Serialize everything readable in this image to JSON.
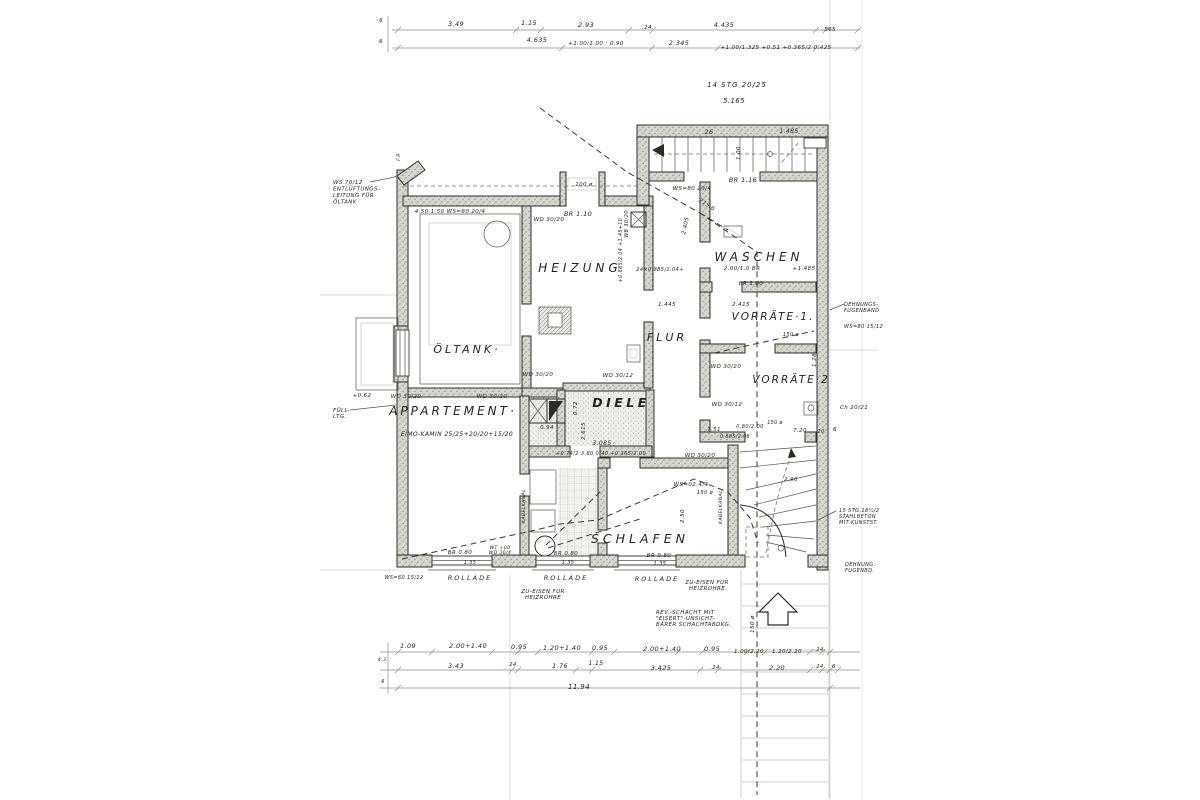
{
  "document_kind": "hand-drawn architectural floor plan (basement / Kellergeschoss), German annotations",
  "colors": {
    "paper": "#ffffff",
    "ink": "#2c2c26",
    "wall_fill": "#d7d7d0",
    "faint": "#c6c6bd"
  },
  "rooms": [
    "HEIZUNG",
    "WASCHEN",
    "VORRÄTE·1.",
    "VORRÄTE·2",
    "FLUR",
    "DIELE",
    "ÖLTANK·",
    "APPARTEMENT·",
    "SCHLAFEN"
  ],
  "annotations": [
    {
      "n": "room-label-heizung",
      "t": "HEIZUNG",
      "x": 580,
      "y": 272,
      "s": 12,
      "ls": 4
    },
    {
      "n": "room-label-waschen",
      "t": "WASCHEN",
      "x": 759,
      "y": 261,
      "s": 12,
      "ls": 4
    },
    {
      "n": "room-label-vorraete-1",
      "t": "VORRÄTE·1.",
      "x": 773,
      "y": 320,
      "s": 10.5,
      "ls": 2
    },
    {
      "n": "room-label-vorraete-2",
      "t": "VORRÄTE·2",
      "x": 791,
      "y": 383,
      "s": 10.5,
      "ls": 2
    },
    {
      "n": "room-label-flur",
      "t": "FLUR",
      "x": 667,
      "y": 341,
      "s": 11,
      "ls": 3
    },
    {
      "n": "room-label-diele",
      "t": "DIELE",
      "x": 621,
      "y": 407,
      "s": 12.5,
      "ls": 3.5,
      "w": "bold"
    },
    {
      "n": "room-label-oeltank",
      "t": "ÖLTANK·",
      "x": 467,
      "y": 353,
      "s": 11,
      "ls": 3
    },
    {
      "n": "room-label-appartement",
      "t": "APPARTEMENT·",
      "x": 453,
      "y": 415,
      "s": 12,
      "ls": 3
    },
    {
      "n": "room-label-schlafen",
      "t": "SCHLAFEN",
      "x": 640,
      "y": 543,
      "s": 12.5,
      "ls": 4
    },
    {
      "n": "note-rollade-1",
      "t": "ROLLADE",
      "x": 470,
      "y": 580,
      "s": 6.5,
      "ls": 2
    },
    {
      "n": "note-rollade-2",
      "t": "ROLLADE",
      "x": 566,
      "y": 580,
      "s": 6.5,
      "ls": 2
    },
    {
      "n": "note-rollade-3",
      "t": "ROLLADE",
      "x": 657,
      "y": 581,
      "s": 6.5,
      "ls": 2
    },
    {
      "n": "note-zueisen-1",
      "L": [
        "ZU-EISEN FUR",
        "HEIZROHRE"
      ],
      "x": 543,
      "y": 593,
      "s": 5.5,
      "lh": 6
    },
    {
      "n": "note-zueisen-2",
      "L": [
        "ZU-EISEN FUR",
        "HEIZROHRE"
      ],
      "x": 707,
      "y": 584,
      "s": 5.5,
      "lh": 6
    },
    {
      "n": "note-rev-schacht",
      "L": [
        "REV.-SCHACHT MIT",
        "\"EISERT\"-UNSICHT-",
        "BARER SCHACHTABDKG."
      ],
      "x": 656,
      "y": 614,
      "s": 5.5,
      "lh": 6,
      "a": "start"
    },
    {
      "n": "note-entlueftung",
      "L": [
        "WS 70/12",
        "ENTLÜFTUNGS-",
        "LEITUNG FÜR",
        "ÖLTANK"
      ],
      "x": 333,
      "y": 184,
      "s": 5.5,
      "lh": 6.5,
      "a": "start"
    },
    {
      "n": "note-fuell-ltg",
      "L": [
        "FÜLL-",
        "LTG."
      ],
      "x": 333,
      "y": 412,
      "s": 5.5,
      "lh": 6,
      "a": "start"
    },
    {
      "t": "+0.62",
      "x": 362,
      "y": 397,
      "s": 5.5
    },
    {
      "n": "note-stair-top",
      "t": "14 STG 20/25",
      "x": 737,
      "y": 87,
      "s": 7,
      "ls": 1
    },
    {
      "t": "5.165",
      "x": 734,
      "y": 103,
      "s": 7
    },
    {
      "t": "BR 1.16",
      "x": 743,
      "y": 182,
      "s": 6.5
    },
    {
      "t": "26",
      "x": 709,
      "y": 134,
      "s": 6.5
    },
    {
      "t": "1.485",
      "x": 789,
      "y": 133,
      "s": 6
    },
    {
      "t": "1.00",
      "x": 740,
      "y": 153,
      "s": 5.5,
      "r": -90
    },
    {
      "t": "WS=80 20/4",
      "x": 692,
      "y": 190,
      "s": 5.5
    },
    {
      "t": "215.6",
      "x": 706,
      "y": 206,
      "s": 5.5,
      "r": 33
    },
    {
      "t": "4.50·1.50  WS=80 20/4",
      "x": 450,
      "y": 213,
      "s": 5.5
    },
    {
      "t": "BR 1.10",
      "x": 578,
      "y": 216,
      "s": 6.5
    },
    {
      "t": "100 ø",
      "x": 584,
      "y": 186,
      "s": 5.5
    },
    {
      "t": "F.R",
      "x": 400,
      "y": 157,
      "s": 4.5,
      "r": -90
    },
    {
      "t": "WD 30/20",
      "x": 549,
      "y": 221,
      "s": 5.5
    },
    {
      "t": "WD 30/20",
      "x": 538,
      "y": 376,
      "s": 5.5
    },
    {
      "t": "WD 30/12",
      "x": 618,
      "y": 377,
      "s": 5.5
    },
    {
      "t": "WD 30/20",
      "x": 726,
      "y": 368,
      "s": 5.5
    },
    {
      "t": "WD 30/12",
      "x": 727,
      "y": 406,
      "s": 5.5
    },
    {
      "t": "WD 30/20",
      "x": 406,
      "y": 398,
      "s": 5.5
    },
    {
      "t": "WD 30/20",
      "x": 492,
      "y": 398,
      "s": 5.5
    },
    {
      "t": "WD 30/20",
      "x": 700,
      "y": 457,
      "s": 5.5
    },
    {
      "t": "WB 30/20",
      "x": 628,
      "y": 224,
      "s": 5,
      "r": -90
    },
    {
      "n": "note-kamin",
      "t": "EIMO-KAMIN 25/25+20/20+15/20",
      "x": 457,
      "y": 436,
      "s": 6
    },
    {
      "t": "2.00/1.0 BR",
      "x": 742,
      "y": 270,
      "s": 5.5
    },
    {
      "t": "BR 1.00",
      "x": 751,
      "y": 285,
      "s": 5.5
    },
    {
      "t": "+1.485",
      "x": 804,
      "y": 270,
      "s": 5.5
    },
    {
      "t": "1.445",
      "x": 667,
      "y": 306,
      "s": 5.5
    },
    {
      "t": "2.415",
      "x": 741,
      "y": 306,
      "s": 5.5
    },
    {
      "t": "24×0.885/2.04+",
      "x": 660,
      "y": 271,
      "s": 5
    },
    {
      "t": "+0.885/2.04 +1.45+10",
      "x": 622,
      "y": 250,
      "s": 4.8,
      "r": -90
    },
    {
      "t": "2.405",
      "x": 687,
      "y": 226,
      "s": 5.5,
      "r": -78
    },
    {
      "n": "note-dehnungsfuge",
      "L": [
        "DEHNUNGS-",
        "FUGENBAND"
      ],
      "x": 844,
      "y": 306,
      "s": 5,
      "lh": 6,
      "a": "start"
    },
    {
      "t": "WS=80 15/12",
      "x": 844,
      "y": 328,
      "s": 5,
      "a": "start"
    },
    {
      "t": "Ch 20/21",
      "x": 840,
      "y": 409,
      "s": 5.5,
      "a": "start"
    },
    {
      "t": "1.28",
      "x": 816,
      "y": 360,
      "s": 5.5,
      "r": -90
    },
    {
      "t": "150 ø",
      "x": 791,
      "y": 336,
      "s": 5
    },
    {
      "n": "note-stair-right",
      "L": [
        "15 STG.18½/2",
        "STAHLBETON",
        "MIT KUNSTST."
      ],
      "x": 839,
      "y": 512,
      "s": 5,
      "lh": 6,
      "a": "start"
    },
    {
      "L": [
        "DEHNUNG.",
        "FUGENBD."
      ],
      "x": 845,
      "y": 566,
      "s": 5,
      "lh": 6,
      "a": "start"
    },
    {
      "t": "3.085",
      "x": 602,
      "y": 445,
      "s": 6
    },
    {
      "t": "+0.74/2 3.80 0.40 +0.365/2.00",
      "x": 601,
      "y": 455,
      "s": 5
    },
    {
      "t": "0.94",
      "x": 547,
      "y": 429,
      "s": 5.5
    },
    {
      "t": "0.72",
      "x": 577,
      "y": 408,
      "s": 5.5,
      "r": -90
    },
    {
      "t": "2.615",
      "x": 585,
      "y": 431,
      "s": 5.5,
      "r": -90
    },
    {
      "t": "1.35",
      "x": 470,
      "y": 564,
      "s": 5
    },
    {
      "t": "1.35",
      "x": 568,
      "y": 564,
      "s": 5
    },
    {
      "t": "1.35",
      "x": 660,
      "y": 565,
      "s": 5
    },
    {
      "t": "BR 0.80",
      "x": 460,
      "y": 554,
      "s": 5.5
    },
    {
      "t": "BR 0.80",
      "x": 566,
      "y": 555,
      "s": 5.5
    },
    {
      "t": "BR 0.80",
      "x": 659,
      "y": 557,
      "s": 5.5
    },
    {
      "L": [
        "WT +00",
        "WD 30/4"
      ],
      "x": 500,
      "y": 549,
      "s": 4.6,
      "lh": 5
    },
    {
      "t": "WS=60 15/12",
      "x": 404,
      "y": 579,
      "s": 5
    },
    {
      "t": "WS=02.4/4",
      "x": 691,
      "y": 486,
      "s": 5.5
    },
    {
      "t": "150 ø",
      "x": 705,
      "y": 494,
      "s": 5
    },
    {
      "t": "2.50",
      "x": 684,
      "y": 516,
      "s": 5.5,
      "r": -90
    },
    {
      "t": "KABELKANAL",
      "x": 722,
      "y": 507,
      "s": 4.6,
      "r": -90
    },
    {
      "t": "KABELKANAL",
      "x": 525,
      "y": 506,
      "s": 4.6,
      "r": -90
    },
    {
      "t": "7.51",
      "x": 714,
      "y": 431,
      "s": 5.5
    },
    {
      "t": "0.80/2.00",
      "x": 750,
      "y": 428,
      "s": 5
    },
    {
      "t": "2.90",
      "x": 791,
      "y": 481,
      "s": 5.5
    },
    {
      "t": "7.20",
      "x": 800,
      "y": 432,
      "s": 5.5
    },
    {
      "t": "150 ø",
      "x": 775,
      "y": 424,
      "s": 4.8
    },
    {
      "t": "0.885/2.08",
      "x": 735,
      "y": 438,
      "s": 4.8
    },
    {
      "t": ".20.",
      "x": 821,
      "y": 433,
      "s": 4.8
    },
    {
      "t": "6",
      "x": 835,
      "y": 431,
      "s": 5.5
    },
    {
      "t": "150 ø",
      "x": 754,
      "y": 624,
      "s": 5.5,
      "r": -90
    },
    {
      "t": "3.49",
      "x": 456,
      "y": 26,
      "s": 6.5
    },
    {
      "t": "1.15",
      "x": 529,
      "y": 25,
      "s": 6.5
    },
    {
      "t": "2.93",
      "x": 586,
      "y": 27,
      "s": 6.5
    },
    {
      "t": ".24.",
      "x": 648,
      "y": 29,
      "s": 5.5
    },
    {
      "t": "4.435",
      "x": 724,
      "y": 27,
      "s": 6.5
    },
    {
      "t": ".565",
      "x": 829,
      "y": 31,
      "s": 5.5
    },
    {
      "t": "4.635",
      "x": 537,
      "y": 42,
      "s": 6.5
    },
    {
      "t": "+1.00/1.00 : 0.90",
      "x": 596,
      "y": 45,
      "s": 5.5
    },
    {
      "t": "2.345",
      "x": 679,
      "y": 45,
      "s": 6.5
    },
    {
      "t": "+1.00/1.325 +0.51 +0.365/2 0.425",
      "x": 776,
      "y": 49,
      "s": 5.5
    },
    {
      "t": "6",
      "x": 381,
      "y": 22,
      "s": 5
    },
    {
      "t": "6",
      "x": 381,
      "y": 43,
      "s": 5
    },
    {
      "t": "1.09",
      "x": 408,
      "y": 648,
      "s": 6.5
    },
    {
      "t": "2.00+1.40",
      "x": 468,
      "y": 648,
      "s": 6.5
    },
    {
      "t": "0.95",
      "x": 519,
      "y": 649,
      "s": 6.5
    },
    {
      "t": "1.20+1.40",
      "x": 562,
      "y": 650,
      "s": 6.5
    },
    {
      "t": "0.95",
      "x": 600,
      "y": 650,
      "s": 6.5
    },
    {
      "t": "2.00+1.40",
      "x": 662,
      "y": 651,
      "s": 6.5
    },
    {
      "t": "0.95",
      "x": 712,
      "y": 651,
      "s": 6.5
    },
    {
      "t": "1.00/2.20",
      "x": 749,
      "y": 653,
      "s": 5.5
    },
    {
      "t": "1.20/2.20",
      "x": 787,
      "y": 653,
      "s": 5.5
    },
    {
      "t": ".24.",
      "x": 820,
      "y": 651,
      "s": 5
    },
    {
      "t": "3.43",
      "x": 456,
      "y": 668,
      "s": 6.5
    },
    {
      "t": ".24.",
      "x": 513,
      "y": 666,
      "s": 5
    },
    {
      "t": "1.76",
      "x": 560,
      "y": 668,
      "s": 6.5
    },
    {
      "t": "1.15",
      "x": 596,
      "y": 665,
      "s": 6
    },
    {
      "t": "3.425",
      "x": 661,
      "y": 670,
      "s": 6.5
    },
    {
      "t": ".24.",
      "x": 716,
      "y": 669,
      "s": 5
    },
    {
      "t": "2.20",
      "x": 777,
      "y": 670,
      "s": 6.5
    },
    {
      "t": ".24.",
      "x": 820,
      "y": 668,
      "s": 5
    },
    {
      "t": "6",
      "x": 834,
      "y": 668,
      "s": 5.5
    },
    {
      "t": "11.94",
      "x": 579,
      "y": 689,
      "s": 7
    },
    {
      "t": "4.3.",
      "x": 383,
      "y": 661,
      "s": 4.5
    },
    {
      "t": "6",
      "x": 383,
      "y": 683,
      "s": 5
    }
  ]
}
